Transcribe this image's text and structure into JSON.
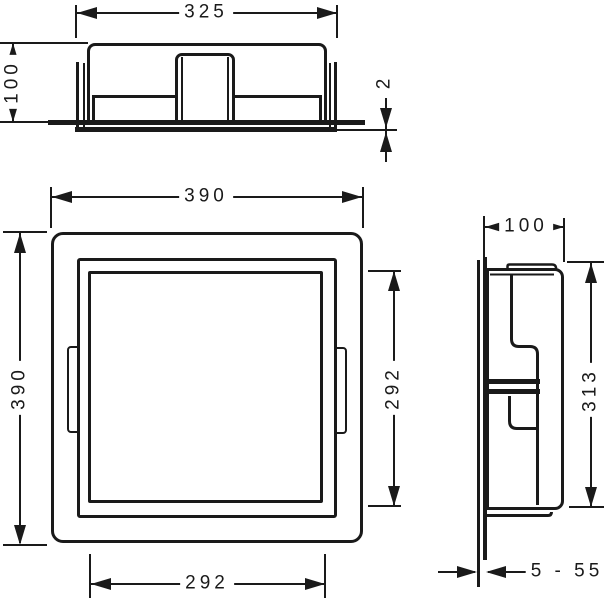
{
  "drawing": {
    "line_color": "#1a1a1a",
    "background_color": "#ffffff",
    "dims": {
      "top_width": "325",
      "top_depth": "100",
      "flange_thickness": "2",
      "front_width": "390",
      "front_height": "390",
      "opening_height": "292",
      "opening_width": "292",
      "side_depth": "100",
      "side_inner_height": "313",
      "tile_thickness_range": "5 - 55"
    }
  }
}
